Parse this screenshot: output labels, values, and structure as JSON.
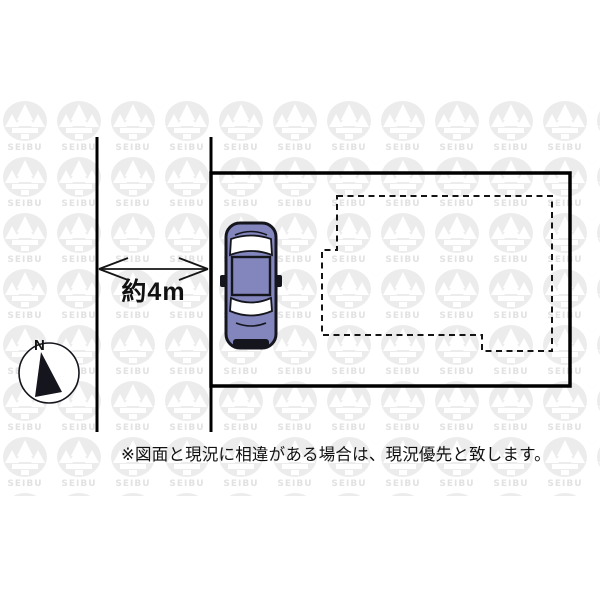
{
  "diagram": {
    "road_width_label": "約4m",
    "compass_north_label": "N",
    "watermark_text": "SEIBU",
    "disclaimer": "※図面と現況に相違がある場合は、現況優先と致します。",
    "colors": {
      "outline": "#000000",
      "car_body": "#8385bd",
      "car_window": "#ffffff",
      "watermark": "#ececec"
    }
  }
}
